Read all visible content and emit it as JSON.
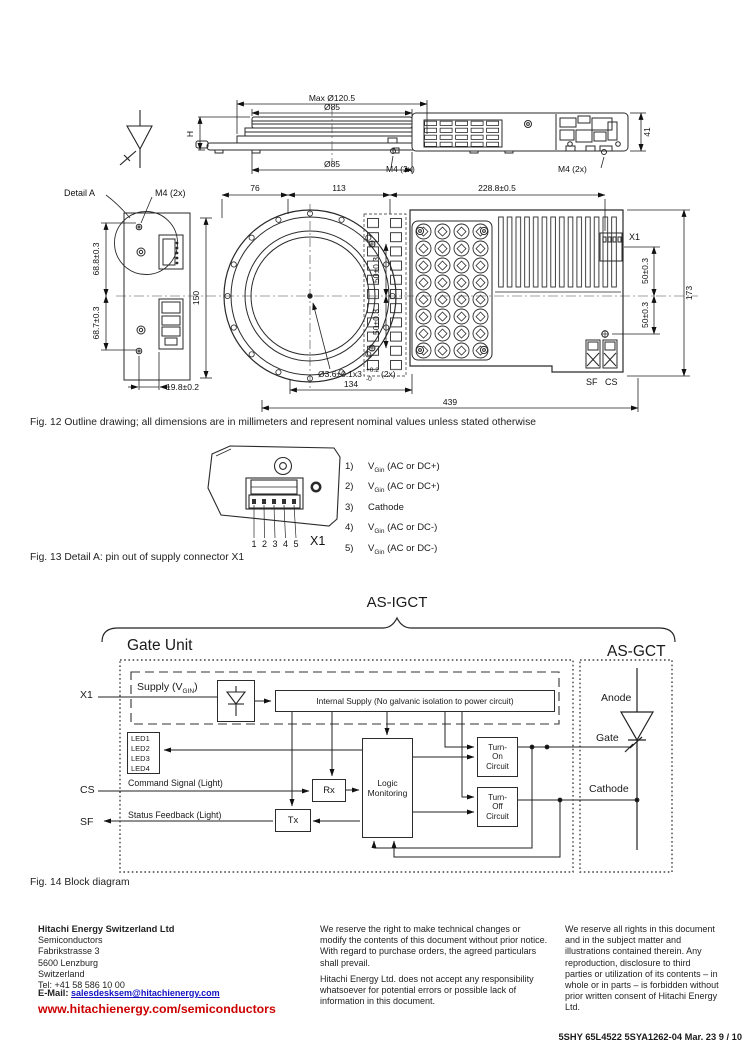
{
  "captions": {
    "fig12": "Fig. 12 Outline drawing; all dimensions are in millimeters and represent nominal values unless stated otherwise",
    "fig13": "Fig. 13 Detail A: pin out of supply connector X1",
    "fig14": "Fig. 14 Block diagram"
  },
  "fig12": {
    "dims": {
      "max_dia": "Max Ø120.5",
      "dia85_top": "Ø85",
      "dia85_bot": "Ø85",
      "h": "H",
      "d41": "41",
      "m4_top_left": "M4 (2x)",
      "m4_top_right": "M4 (2x)",
      "detail_a": "Detail A",
      "m4_detail": "M4 (2x)",
      "d76": "76",
      "d113": "113",
      "d2288": "228.8±0.5",
      "d688": "68.8±0.3",
      "d687": "68.7±0.3",
      "d150": "150",
      "d198": "19.8±0.2",
      "d50a": "50±0.3",
      "d50b": "50±0.3",
      "d50c": "50±0.3",
      "d50d": "50±0.3",
      "d173": "173",
      "d134": "134",
      "d439": "439",
      "x1": "X1",
      "sf": "SF",
      "cs": "CS",
      "hole": "Ø3.6±0.1x3",
      "hole_sup": "+0.2",
      "hole_sub": "-0",
      "hole_2x": "(2x)"
    }
  },
  "fig13": {
    "x1_big": "X1",
    "digits": [
      "1",
      "2",
      "3",
      "4",
      "5"
    ],
    "pins": [
      {
        "num": "1)",
        "pre": "V",
        "sub": "Gin",
        "post": " (AC or DC+)"
      },
      {
        "num": "2)",
        "pre": "V",
        "sub": "Gin",
        "post": " (AC or DC+)"
      },
      {
        "num": "3)",
        "pre": "Cathode",
        "sub": "",
        "post": ""
      },
      {
        "num": "4)",
        "pre": "V",
        "sub": "Gin",
        "post": " (AC or DC-)"
      },
      {
        "num": "5)",
        "pre": "V",
        "sub": "Gin",
        "post": " (AC or DC-)"
      }
    ]
  },
  "fig14": {
    "title": "AS-IGCT",
    "gate_unit": "Gate Unit",
    "as_gct": "AS-GCT",
    "x1": "X1",
    "supply_pre": "Supply (V",
    "supply_sub": "GIN",
    "supply_post": ")",
    "internal": "Internal Supply (No galvanic isolation to power circuit)",
    "leds": [
      "LED1",
      "LED2",
      "LED3",
      "LED4"
    ],
    "cs": "CS",
    "sf": "SF",
    "cmd": "Command Signal (Light)",
    "stat": "Status Feedback (Light)",
    "rx": "Rx",
    "tx": "Tx",
    "logic1": "Logic",
    "logic2": "Monitoring",
    "ton1": "Turn-",
    "ton2": "On",
    "ton3": "Circuit",
    "toff1": "Turn-",
    "toff2": "Off",
    "toff3": "Circuit",
    "anode": "Anode",
    "gate": "Gate",
    "cathode": "Cathode"
  },
  "footer": {
    "company": {
      "name": "Hitachi Energy Switzerland Ltd",
      "lines": [
        "Semiconductors",
        "Fabrikstrasse 3",
        "5600 Lenzburg",
        "Switzerland",
        "Tel: +41 58 586 10 00"
      ],
      "email_label": "E-Mail:",
      "email": "salesdesksem@hitachienergy.com",
      "website": "www.hitachienergy.com/semiconductors"
    },
    "center": {
      "p1": "We reserve the right to make technical changes or modify the contents of this document without prior notice. With regard to purchase orders, the agreed particulars shall prevail.",
      "p2": "Hitachi Energy Ltd. does not accept any responsibility whatsoever for potential errors or possible lack of information in this document."
    },
    "right": {
      "p1": "We reserve all rights in this document and in the subject matter and illustrations contained therein. Any reproduction, disclosure to third parties or utilization of its contents – in whole or in parts – is forbidden without prior written consent of Hitachi Energy Ltd."
    },
    "docref": "5SHY 65L4522 5SYA1262-04 Mar. 23  9 / 10"
  }
}
